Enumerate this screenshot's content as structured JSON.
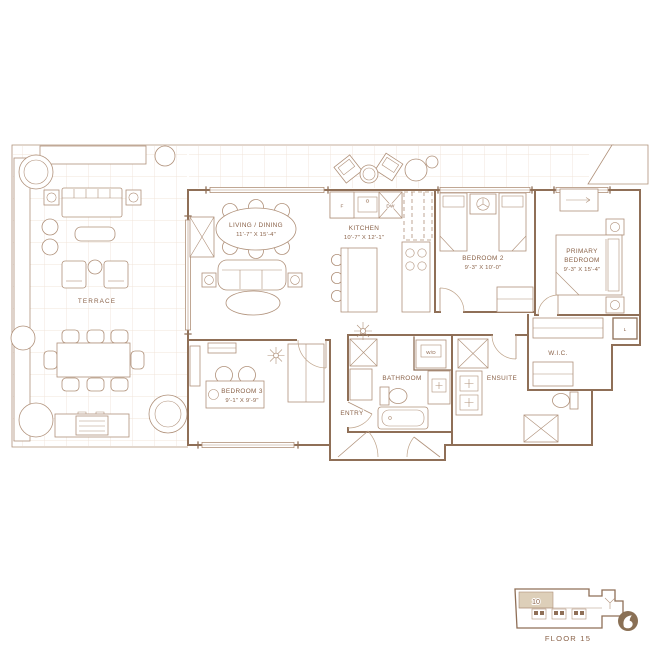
{
  "document": {
    "type": "residential floor plan"
  },
  "colors": {
    "line": "#b0917a",
    "wall": "#8f6f57",
    "text": "#8a6248",
    "unit_highlight": "#ddcfb9",
    "logo": "#8a7055",
    "paver_grid": "#f0e4d9",
    "background": "#ffffff"
  },
  "rooms": {
    "terrace": {
      "label": "TERRACE"
    },
    "living_dining": {
      "label": "LIVING / DINING",
      "dims": "11'-7\" X 15'-4\""
    },
    "kitchen": {
      "label": "KITCHEN",
      "dims": "10'-7\" X 12'-1\""
    },
    "bedroom2": {
      "label": "BEDROOM 2",
      "dims": "9'-3\" X 10'-0\""
    },
    "primary_bedroom": {
      "label_line1": "PRIMARY",
      "label_line2": "BEDROOM",
      "dims": "9'-3\" X 15'-4\""
    },
    "bedroom3": {
      "label": "BEDROOM 3",
      "dims": "9'-1\" X 9'-9\""
    },
    "entry": {
      "label": "ENTRY"
    },
    "bathroom": {
      "label": "BATHROOM"
    },
    "ensuite": {
      "label": "ENSUITE"
    },
    "wic": {
      "label": "W.I.C."
    }
  },
  "closets": {
    "washer_dryer": "W/D",
    "linen": "L"
  },
  "appliances": {
    "fridge": "F",
    "dishwasher": "DW"
  },
  "keyplan": {
    "unit_number": "10",
    "floor_label": "FLOOR 15"
  },
  "icons": {
    "brand_logo": "leaf-logo",
    "ceiling_fixture": "starburst",
    "planter_marker": "circled-marker"
  }
}
